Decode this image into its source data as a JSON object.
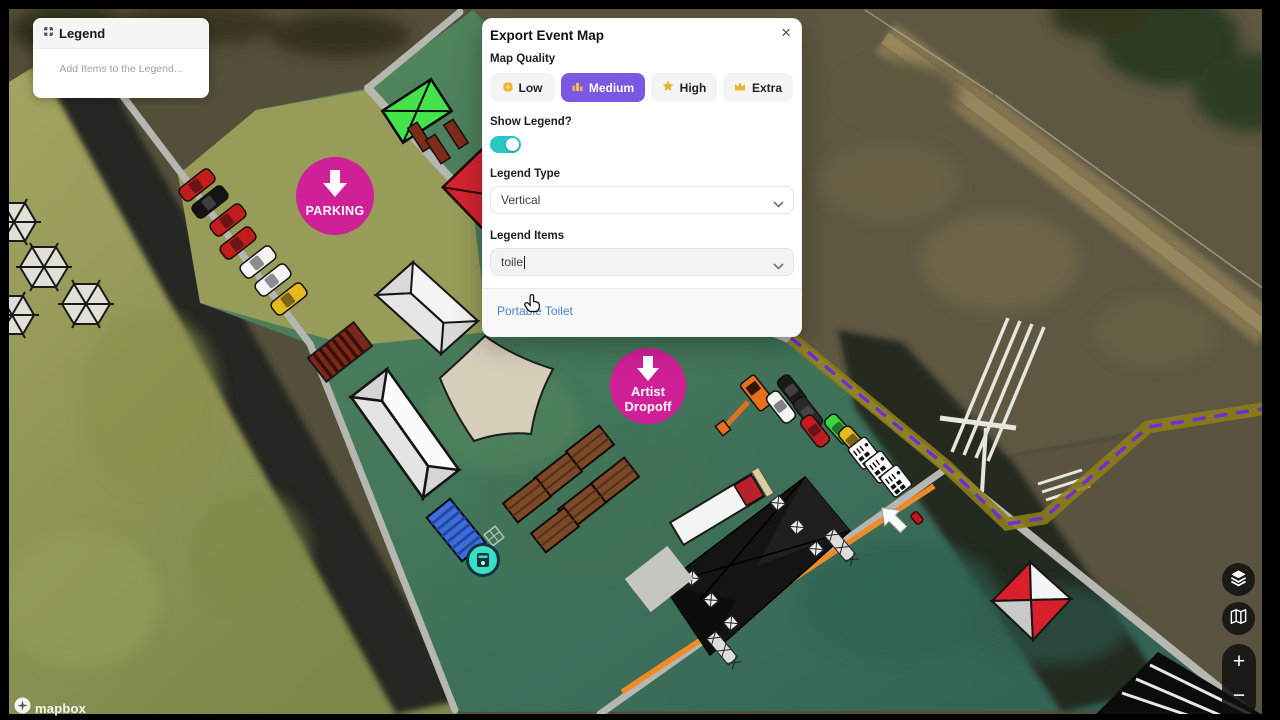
{
  "legend_panel": {
    "title": "Legend",
    "empty_text": "Add Items to the Legend..."
  },
  "export_modal": {
    "title": "Export Event Map",
    "close_label": "×",
    "map_quality_label": "Map Quality",
    "quality_options": [
      {
        "label": "Low",
        "icon": "coin-icon",
        "selected": false
      },
      {
        "label": "Medium",
        "icon": "podium-icon",
        "selected": true
      },
      {
        "label": "High",
        "icon": "star-icon",
        "selected": false
      },
      {
        "label": "Extra",
        "icon": "crown-icon",
        "selected": false
      }
    ],
    "selected_quality": "Medium",
    "show_legend_label": "Show Legend?",
    "show_legend_on": true,
    "legend_type_label": "Legend Type",
    "legend_type_value": "Vertical",
    "legend_items_label": "Legend Items",
    "legend_items_input": "toile",
    "suggestion": "Portable Toilet"
  },
  "map_controls": {
    "zoom_in": "+",
    "zoom_out": "−",
    "layers_icon": "layers-icon",
    "basemap_icon": "map-icon"
  },
  "attribution": {
    "logo_text": "mapbox"
  },
  "markers": {
    "parking": "PARKING",
    "artist_line1": "Artist",
    "artist_line2": "Dropoff"
  },
  "vehicles": {
    "parking_row": [
      "#c41c1c",
      "#141414",
      "#c41c1c",
      "#c41c1c",
      "#f4f4f4",
      "#f4f4f4",
      "#e6b91e"
    ],
    "roadside_row": [
      "#1a1a1a",
      "#f4f4f4",
      "#2a2a2a",
      "#c41c1c",
      "#3bd53e",
      "#e6b91e"
    ]
  },
  "colors": {
    "accent_purple": "#7c58e2",
    "toggle_teal": "#2bc7c7",
    "pin_magenta": "#cf2097",
    "link_blue": "#4d82c7",
    "route_purple": "#6c2fd8",
    "route_olive": "#8c7c18",
    "path_orange": "#ef8a28"
  }
}
